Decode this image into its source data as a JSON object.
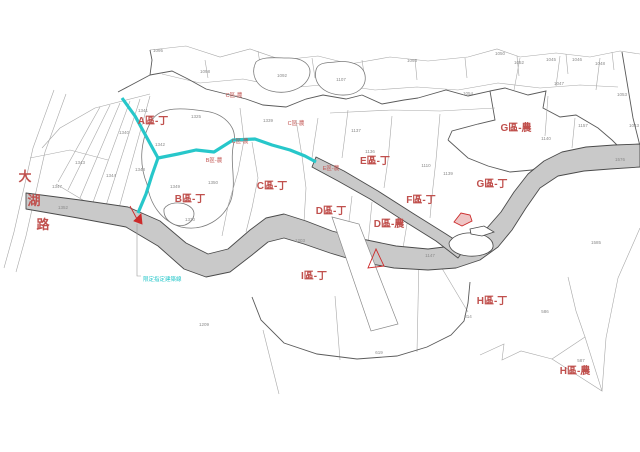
{
  "map": {
    "road_name": {
      "text": "大湖路",
      "chars": [
        {
          "ch": "大",
          "x": 25,
          "y": 181
        },
        {
          "ch": "湖",
          "x": 34,
          "y": 205
        },
        {
          "ch": "路",
          "x": 43,
          "y": 229
        }
      ]
    },
    "note": {
      "text": "限定指定建築線",
      "x": 143,
      "y": 281
    },
    "zone_labels": [
      {
        "text": "A區-丁",
        "x": 153,
        "y": 124
      },
      {
        "text": "B區-丁",
        "x": 190,
        "y": 202
      },
      {
        "text": "C區-丁",
        "x": 272,
        "y": 189
      },
      {
        "text": "D區-丁",
        "x": 331,
        "y": 214
      },
      {
        "text": "D區-農",
        "x": 389,
        "y": 227
      },
      {
        "text": "E區-丁",
        "x": 375,
        "y": 164
      },
      {
        "text": "F區-丁",
        "x": 421,
        "y": 203
      },
      {
        "text": "G區-丁",
        "x": 492,
        "y": 187
      },
      {
        "text": "G區-農",
        "x": 516,
        "y": 131
      },
      {
        "text": "H區-丁",
        "x": 492,
        "y": 304
      },
      {
        "text": "H區-農",
        "x": 575,
        "y": 374
      },
      {
        "text": "I區-丁",
        "x": 314,
        "y": 279
      }
    ],
    "small_zone_labels": [
      {
        "text": "C區-農",
        "x": 240,
        "y": 143
      },
      {
        "text": "B區-農",
        "x": 214,
        "y": 162
      },
      {
        "text": "C區-農",
        "x": 296,
        "y": 125
      },
      {
        "text": "C區-農",
        "x": 234,
        "y": 97
      },
      {
        "text": "E區-農",
        "x": 331,
        "y": 170
      }
    ],
    "parcel_numbers": [
      {
        "text": "1095",
        "x": 158,
        "y": 52
      },
      {
        "text": "1098",
        "x": 205,
        "y": 73
      },
      {
        "text": "1092",
        "x": 282,
        "y": 77
      },
      {
        "text": "1107",
        "x": 341,
        "y": 81
      },
      {
        "text": "1093",
        "x": 412,
        "y": 62
      },
      {
        "text": "1050",
        "x": 500,
        "y": 55
      },
      {
        "text": "1054",
        "x": 468,
        "y": 95
      },
      {
        "text": "1052",
        "x": 519,
        "y": 64
      },
      {
        "text": "1045",
        "x": 551,
        "y": 61
      },
      {
        "text": "1046",
        "x": 577,
        "y": 61
      },
      {
        "text": "1047",
        "x": 559,
        "y": 85
      },
      {
        "text": "1048",
        "x": 600,
        "y": 65
      },
      {
        "text": "1053",
        "x": 622,
        "y": 96
      },
      {
        "text": "1157",
        "x": 583,
        "y": 127
      },
      {
        "text": "1140",
        "x": 546,
        "y": 140
      },
      {
        "text": "1043",
        "x": 634,
        "y": 127
      },
      {
        "text": "1325",
        "x": 196,
        "y": 118
      },
      {
        "text": "1341",
        "x": 143,
        "y": 112
      },
      {
        "text": "1340",
        "x": 124,
        "y": 134
      },
      {
        "text": "1343",
        "x": 80,
        "y": 164
      },
      {
        "text": "1347",
        "x": 57,
        "y": 188
      },
      {
        "text": "1344",
        "x": 111,
        "y": 177
      },
      {
        "text": "1348",
        "x": 140,
        "y": 171
      },
      {
        "text": "1342",
        "x": 160,
        "y": 146
      },
      {
        "text": "1349",
        "x": 175,
        "y": 188
      },
      {
        "text": "1350",
        "x": 213,
        "y": 184
      },
      {
        "text": "1330",
        "x": 190,
        "y": 221
      },
      {
        "text": "1352",
        "x": 63,
        "y": 209
      },
      {
        "text": "1339",
        "x": 268,
        "y": 122
      },
      {
        "text": "1137",
        "x": 356,
        "y": 132
      },
      {
        "text": "1136",
        "x": 370,
        "y": 153
      },
      {
        "text": "1110",
        "x": 426,
        "y": 167
      },
      {
        "text": "1139",
        "x": 448,
        "y": 175
      },
      {
        "text": "1147",
        "x": 430,
        "y": 257
      },
      {
        "text": "1203",
        "x": 300,
        "y": 242
      },
      {
        "text": "1209",
        "x": 204,
        "y": 326
      },
      {
        "text": "619",
        "x": 379,
        "y": 354
      },
      {
        "text": "314",
        "x": 468,
        "y": 318
      },
      {
        "text": "586",
        "x": 545,
        "y": 313
      },
      {
        "text": "587",
        "x": 581,
        "y": 362
      },
      {
        "text": "1576",
        "x": 620,
        "y": 161
      },
      {
        "text": "1585",
        "x": 596,
        "y": 244
      }
    ],
    "colors": {
      "zone_label_red": "#c0504d",
      "marker_red": "#cc2a2a",
      "cyan_line": "#27c7ca",
      "road_fill": "#c9c9c9",
      "road_edge": "#4a4a4a",
      "parcel_line": "#a8a8a8",
      "parcel_number_gray": "#8a8a8a",
      "background": "#ffffff"
    }
  }
}
